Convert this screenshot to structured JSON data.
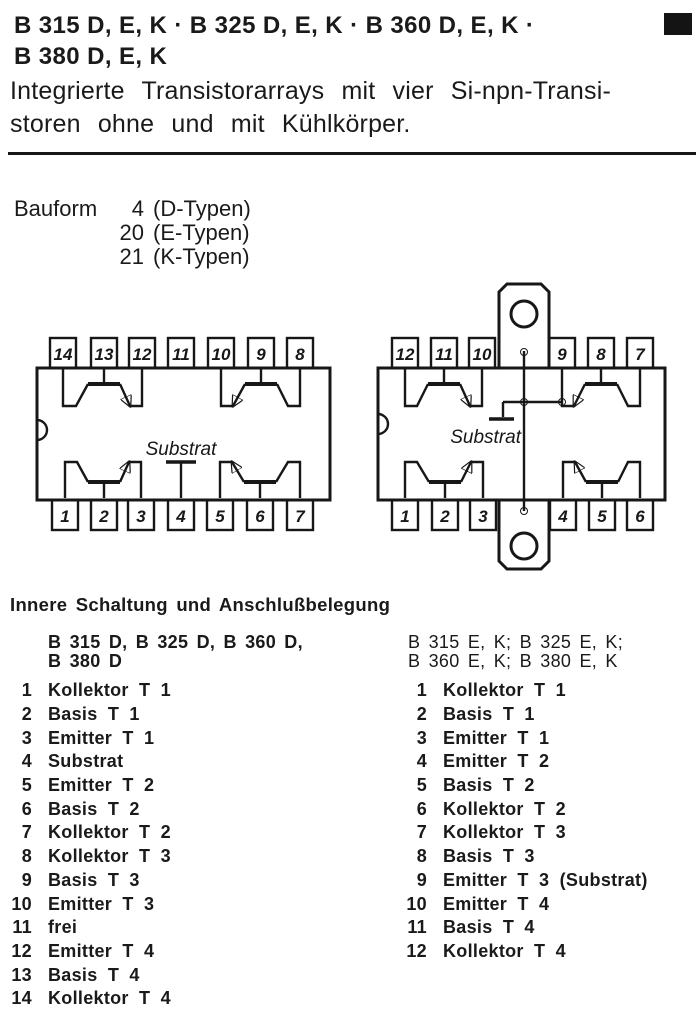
{
  "colors": {
    "ink": "#1a1a1a",
    "paper": "#ffffff"
  },
  "header": {
    "title_line1": "B 315 D, E, K · B 325 D, E, K · B 360 D, E, K ·",
    "title_line2": "B 380 D, E, K",
    "subtitle_line1": "Integrierte Transistorarrays mit vier Si-npn-Transi-",
    "subtitle_line2": "storen ohne und mit Kühlkörper."
  },
  "bauform": {
    "label": "Bauform",
    "rows": [
      {
        "num": "4",
        "text": "(D-Typen)"
      },
      {
        "num": "20",
        "text": "(E-Typen)"
      },
      {
        "num": "21",
        "text": "(K-Typen)"
      }
    ]
  },
  "diagrams": {
    "left": {
      "substrate_label": "Substrat",
      "top_pins": [
        "14",
        "13",
        "12",
        "11",
        "10",
        "9",
        "8"
      ],
      "bottom_pins": [
        "1",
        "2",
        "3",
        "4",
        "5",
        "6",
        "7"
      ]
    },
    "right": {
      "substrate_label": "Substrat",
      "top_pins": [
        "12",
        "11",
        "10",
        "9",
        "8",
        "7"
      ],
      "bottom_pins": [
        "1",
        "2",
        "3",
        "4",
        "5",
        "6"
      ]
    }
  },
  "section": {
    "heading": "Innere Schaltung und Anschlußbelegung",
    "left_column": {
      "header_line1": "B 315 D, B 325 D, B 360 D,",
      "header_line2": "B 380 D",
      "pins": [
        {
          "num": "1",
          "label": "Kollektor T 1"
        },
        {
          "num": "2",
          "label": "Basis T 1"
        },
        {
          "num": "3",
          "label": "Emitter T 1"
        },
        {
          "num": "4",
          "label": "Substrat"
        },
        {
          "num": "5",
          "label": "Emitter T 2"
        },
        {
          "num": "6",
          "label": "Basis T 2"
        },
        {
          "num": "7",
          "label": "Kollektor T 2"
        },
        {
          "num": "8",
          "label": "Kollektor T 3"
        },
        {
          "num": "9",
          "label": "Basis T 3"
        },
        {
          "num": "10",
          "label": "Emitter T 3"
        },
        {
          "num": "11",
          "label": "frei"
        },
        {
          "num": "12",
          "label": "Emitter T 4"
        },
        {
          "num": "13",
          "label": "Basis T 4"
        },
        {
          "num": "14",
          "label": "Kollektor T 4"
        }
      ]
    },
    "right_column": {
      "header_line1": "B 315 E, K; B 325 E, K;",
      "header_line2": "B 360 E, K; B 380 E, K",
      "pins": [
        {
          "num": "1",
          "label": "Kollektor T 1"
        },
        {
          "num": "2",
          "label": "Basis T 1"
        },
        {
          "num": "3",
          "label": "Emitter T 1"
        },
        {
          "num": "4",
          "label": "Emitter T 2"
        },
        {
          "num": "5",
          "label": "Basis T 2"
        },
        {
          "num": "6",
          "label": "Kollektor T 2"
        },
        {
          "num": "7",
          "label": "Kollektor T 3"
        },
        {
          "num": "8",
          "label": "Basis T 3"
        },
        {
          "num": "9",
          "label": "Emitter T 3 (Substrat)"
        },
        {
          "num": "10",
          "label": "Emitter T 4"
        },
        {
          "num": "11",
          "label": "Basis T 4"
        },
        {
          "num": "12",
          "label": "Kollektor T 4"
        }
      ]
    }
  }
}
